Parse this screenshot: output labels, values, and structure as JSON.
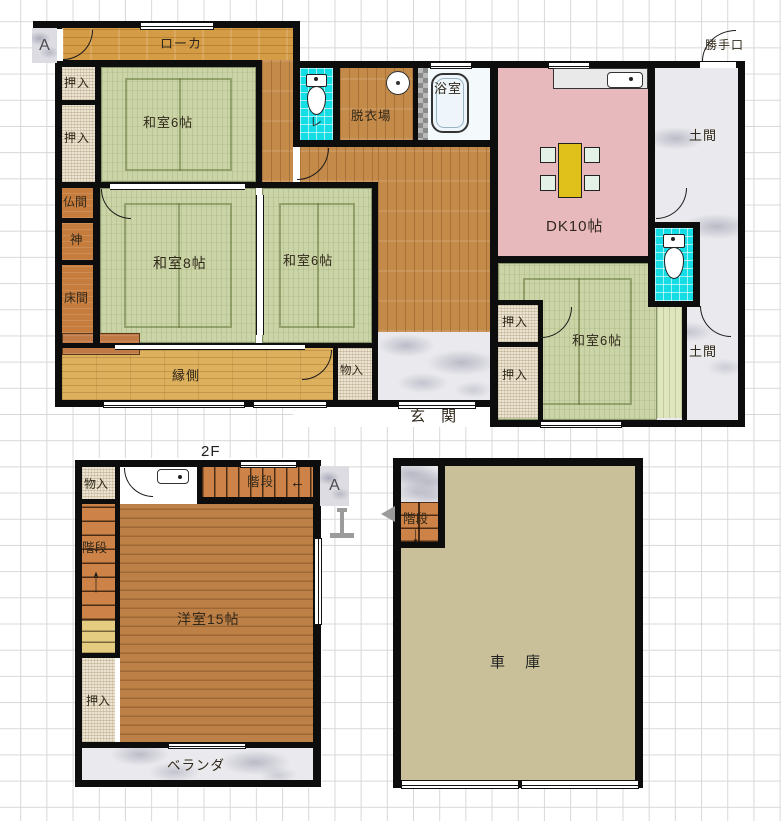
{
  "f1": {
    "marker_a": "A",
    "corridor": "ローカ",
    "oshiire1": "押入",
    "oshiire2": "押入",
    "washitsu6_1": "和室6帖",
    "toilet1_label": "レ",
    "datsuiba": "脱衣場",
    "bath": "浴室",
    "dk": "DK10帖",
    "katteguchi": "勝手口",
    "doma1": "土間",
    "doma2": "土間",
    "butsuma": "仏間",
    "kami": "神",
    "tokonoma": "床間",
    "washitsu8": "和室8帖",
    "washitsu6_2": "和室6帖",
    "engawa": "縁側",
    "monoire": "物入",
    "genkan": "玄 関",
    "oshiire3": "押入",
    "oshiire4": "押入",
    "washitsu6_3": "和室6帖"
  },
  "f2": {
    "title": "2F",
    "marker_a": "A",
    "monoire": "物入",
    "kaidan_top": "階段",
    "kaidan_top_arrow": "←",
    "kaidan_left": "階段",
    "kaidan_left_arrow": "↑",
    "yoshitsu": "洋室15帖",
    "oshiire": "押入",
    "veranda": "ベランダ"
  },
  "garage": {
    "kaidan": "階段",
    "kaidan_arrow": "↓",
    "shako": "車 庫"
  },
  "colors": {
    "tatami_green": "#cbd4a6",
    "corridor_wood": "#d59c46",
    "hall_wood": "#c48a4a",
    "room2f_wood": "#bd8046",
    "engawa_wood": "#ddb05e",
    "closet_beige": "#ece3d0",
    "alcove_orange": "#c67c3c",
    "dk_pink": "#e7b9bd",
    "toilet_cyan": "#14dde6",
    "stone_marble": "#eaeaee",
    "garage_tan": "#c9c09a",
    "stairs_orange": "#cd8347",
    "table_yellow": "#e0c01a",
    "chair_green": "#e4f1e6",
    "wall_black": "#0d0d0d"
  }
}
